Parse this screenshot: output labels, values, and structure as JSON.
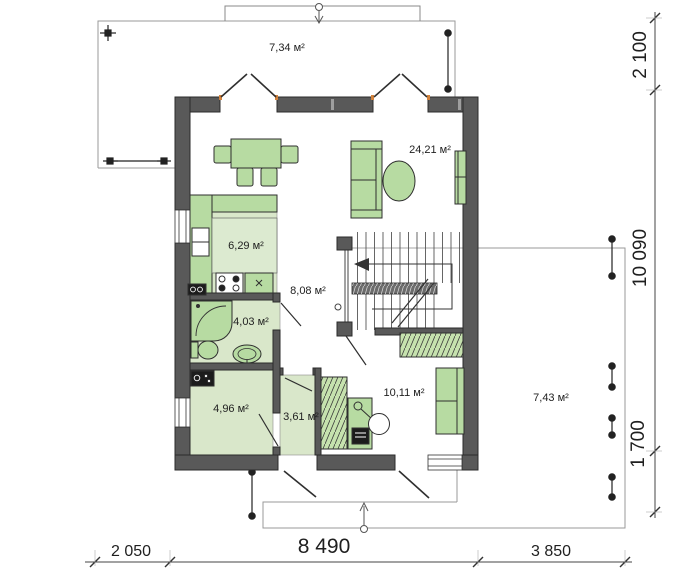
{
  "plan": {
    "title": "floor-plan-first-storey",
    "rooms": {
      "terrace_top": "7,34 м²",
      "living": "24,21 м²",
      "kitchen": "6,29 м²",
      "hall": "8,08 м²",
      "bathroom": "4,03 м²",
      "utility": "4,96 м²",
      "vestibule": "3,61 м²",
      "cabinet": "10,11 м²",
      "terrace_right": "7,43 м²"
    },
    "dimensions": {
      "right_top": "2 100",
      "right_middle": "10 090",
      "right_bottom": "1 700",
      "bottom_left": "2 050",
      "bottom_center": "8 490",
      "bottom_right": "3 850"
    },
    "colors": {
      "wall": "#595959",
      "furniture_green": "#b7dba2",
      "floor_tint": "#d9e7ca",
      "door_jamb_accent": "#d2823c",
      "line": "#1f1f1f"
    }
  }
}
